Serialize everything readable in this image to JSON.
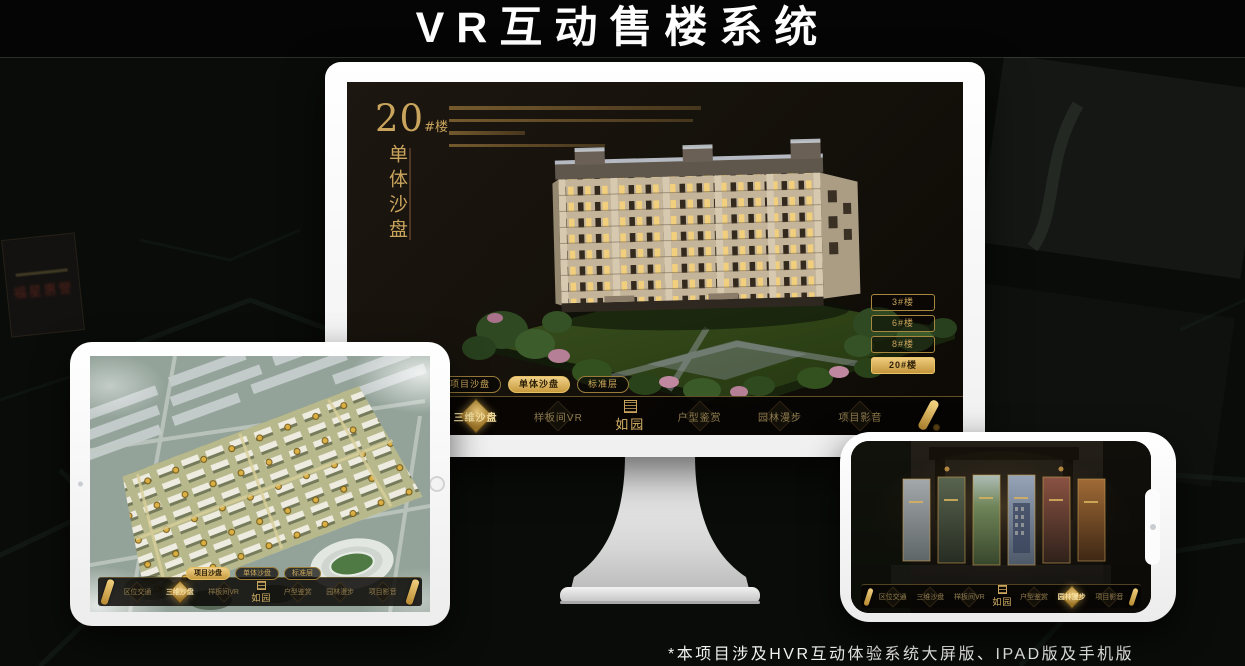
{
  "page": {
    "title": "VR互动售楼系统",
    "footnote": "*本项目涉及HVR互动体验系统大屏版、IPAD版及手机版"
  },
  "colors": {
    "gold": "#c9a45c",
    "gold_bright": "#efcc7d",
    "screen_background": "#14100a",
    "page_background": "#0a0c09"
  },
  "background": {
    "plaque_text": "福星惠誉"
  },
  "monitor_ui": {
    "building_label": {
      "number": "20",
      "suffix": "#楼",
      "vertical_title": "单体沙盘"
    },
    "building_buttons": [
      {
        "label": "3#楼",
        "active": false
      },
      {
        "label": "6#楼",
        "active": false
      },
      {
        "label": "8#楼",
        "active": false
      },
      {
        "label": "20#楼",
        "active": true
      }
    ],
    "tabs": [
      {
        "label": "项目沙盘",
        "active": false
      },
      {
        "label": "单体沙盘",
        "active": true
      },
      {
        "label": "标准层",
        "active": false
      }
    ],
    "menu": [
      {
        "label": "区位交通",
        "active": false
      },
      {
        "label": "三维沙盘",
        "active": true
      },
      {
        "label": "样板间VR",
        "active": false
      },
      {
        "label": "户型鉴赏",
        "active": false
      },
      {
        "label": "园林漫步",
        "active": false
      },
      {
        "label": "项目影音",
        "active": false
      }
    ],
    "logo": "如园"
  },
  "tablet_ui": {
    "tabs": [
      {
        "label": "项目沙盘",
        "active": true
      },
      {
        "label": "单体沙盘",
        "active": false
      },
      {
        "label": "标准层",
        "active": false
      }
    ],
    "menu": [
      {
        "label": "区位交通",
        "active": false
      },
      {
        "label": "三维沙盘",
        "active": true
      },
      {
        "label": "样板间VR",
        "active": false
      },
      {
        "label": "户型鉴赏",
        "active": false
      },
      {
        "label": "园林漫步",
        "active": false
      },
      {
        "label": "项目影音",
        "active": false
      }
    ],
    "logo": "如园"
  },
  "phone_ui": {
    "menu": [
      {
        "label": "区位交通",
        "active": false
      },
      {
        "label": "三维沙盘",
        "active": false
      },
      {
        "label": "样板间VR",
        "active": false
      },
      {
        "label": "户型鉴赏",
        "active": false
      },
      {
        "label": "园林漫步",
        "active": true
      },
      {
        "label": "项目影音",
        "active": false
      }
    ],
    "logo": "如园"
  }
}
